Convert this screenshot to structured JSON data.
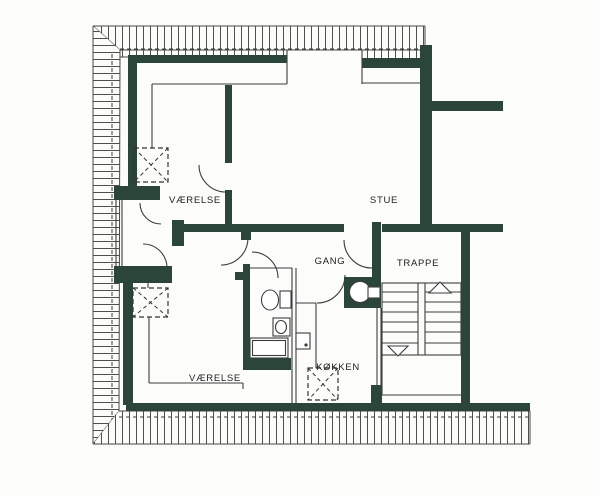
{
  "plan": {
    "rooms": {
      "bedroom_top": {
        "label": "VÆRELSE"
      },
      "living_room": {
        "label": "STUE"
      },
      "hallway": {
        "label": "GANG"
      },
      "staircase": {
        "label": "TRAPPE"
      },
      "kitchen": {
        "label": "KØKKEN"
      },
      "bedroom_bottom": {
        "label": "VÆRELSE"
      }
    },
    "fixtures": [
      "skylight-x-icon",
      "toilet-icon",
      "washbasin-icon",
      "shower-tray-icon",
      "stove-icon",
      "water-closet-icon",
      "stairs-up-arrow-icon",
      "stairs-down-arrow-icon"
    ]
  },
  "colors": {
    "wall": "#2b4638",
    "line": "#3d3d3d",
    "hatch": "#4f4f4f",
    "paper": "#fcfcfa",
    "label": "#1d1d1d"
  }
}
